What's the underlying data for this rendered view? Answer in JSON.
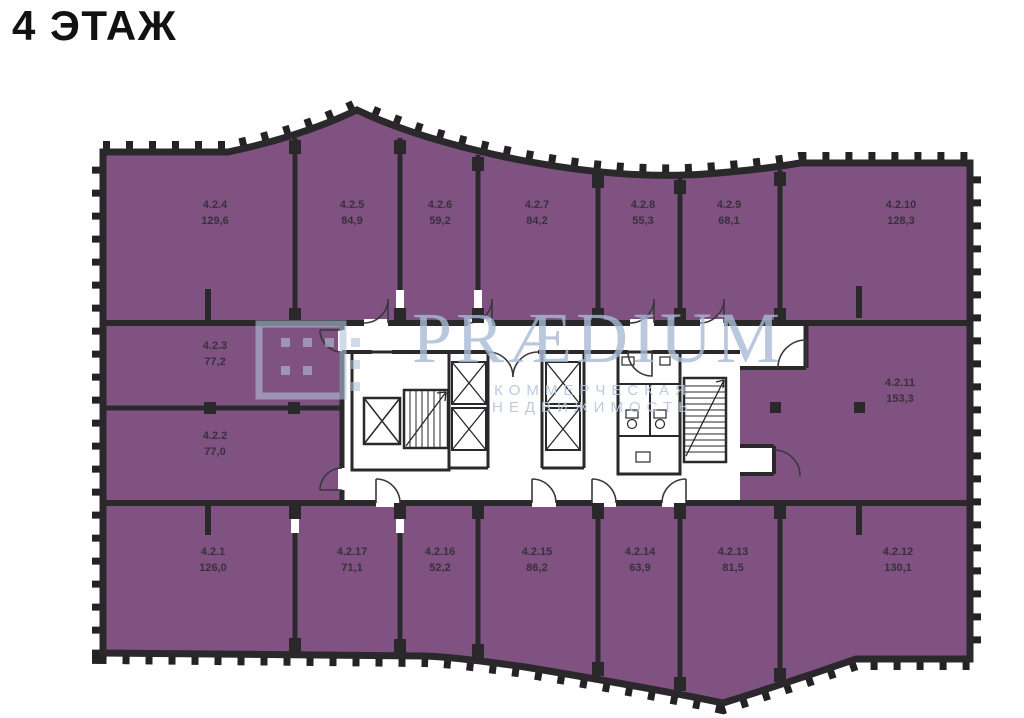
{
  "page": {
    "title": "4 ЭТАЖ"
  },
  "watermark": {
    "brand": "PRÆDIUM",
    "subtitle": "КОММЕРЧЕСКАЯ НЕДВИЖИМОСТЬ"
  },
  "colors": {
    "room_fill": "#7F5282",
    "wall": "#2A282A",
    "room_label_text": "#39303B",
    "watermark_blue": "#B6C5DA",
    "title_text": "#121212",
    "background": "#FFFFFF"
  },
  "floor_plan": {
    "floor_number": "4",
    "rooms": [
      {
        "id": "4.2.4",
        "area": "129,6"
      },
      {
        "id": "4.2.5",
        "area": "84,9"
      },
      {
        "id": "4.2.6",
        "area": "59,2"
      },
      {
        "id": "4.2.7",
        "area": "84,2"
      },
      {
        "id": "4.2.8",
        "area": "55,3"
      },
      {
        "id": "4.2.9",
        "area": "68,1"
      },
      {
        "id": "4.2.10",
        "area": "128,3"
      },
      {
        "id": "4.2.3",
        "area": "77,2"
      },
      {
        "id": "4.2.2",
        "area": "77,0"
      },
      {
        "id": "4.2.11",
        "area": "153,3"
      },
      {
        "id": "4.2.1",
        "area": "126,0"
      },
      {
        "id": "4.2.17",
        "area": "71,1"
      },
      {
        "id": "4.2.16",
        "area": "52,2"
      },
      {
        "id": "4.2.15",
        "area": "86,2"
      },
      {
        "id": "4.2.14",
        "area": "63,9"
      },
      {
        "id": "4.2.13",
        "area": "81,5"
      },
      {
        "id": "4.2.12",
        "area": "130,1"
      }
    ]
  }
}
